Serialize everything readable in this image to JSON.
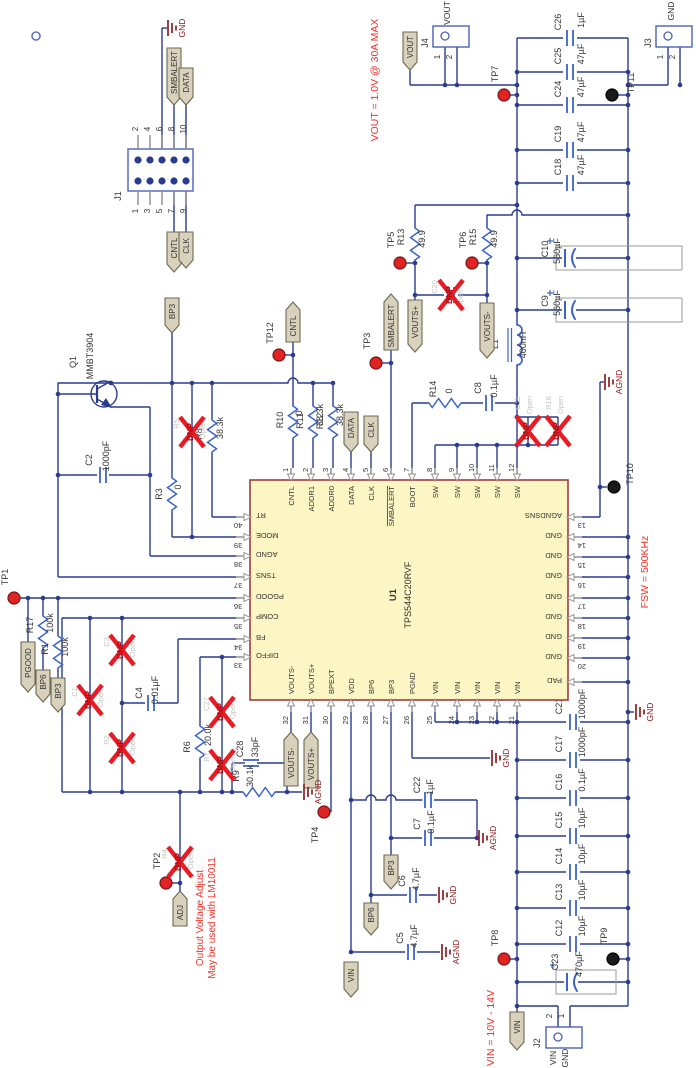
{
  "notes": {
    "vout": "VOUT = 1.0V @ 30A MAX",
    "fsw": "FSW = 500KHz",
    "vin": "VIN = 10V - 14V",
    "adj_line1": "Output Voltage Adjust",
    "adj_line2": "May be used with LM10011"
  },
  "nets": {
    "smbalert": "SMBALERT",
    "data": "DATA",
    "cntl": "CNTL",
    "clk": "CLK",
    "vout": "VOUT",
    "vin": "VIN",
    "gnd": "GND",
    "agnd": "AGND",
    "bp3": "BP3",
    "bp6": "BP6",
    "pgood": "PGOOD",
    "adj": "ADJ",
    "vouts_plus": "VOUTS+",
    "vouts_minus": "VOUTS-"
  },
  "ic": {
    "ref": "U1",
    "part": "TPS544C20RVF",
    "pad": "PAD",
    "top_pins": [
      {
        "num": "1",
        "name": "CNTL"
      },
      {
        "num": "2",
        "name": "ADDR1"
      },
      {
        "num": "3",
        "name": "ADDR0"
      },
      {
        "num": "4",
        "name": "DATA"
      },
      {
        "num": "5",
        "name": "CLK"
      },
      {
        "num": "6",
        "name": "SMBALERT",
        "bar": true
      },
      {
        "num": "7",
        "name": "BOOT"
      },
      {
        "num": "8",
        "name": "SW"
      },
      {
        "num": "9",
        "name": "SW"
      },
      {
        "num": "10",
        "name": "SW"
      },
      {
        "num": "11",
        "name": "SW"
      },
      {
        "num": "12",
        "name": "SW"
      }
    ],
    "bottom_pins": [
      {
        "num": "32",
        "name": "VOUTS-"
      },
      {
        "num": "31",
        "name": "VOUTS+"
      },
      {
        "num": "30",
        "name": "BPEXT"
      },
      {
        "num": "29",
        "name": "VDD"
      },
      {
        "num": "28",
        "name": "BP6"
      },
      {
        "num": "27",
        "name": "BP3"
      },
      {
        "num": "26",
        "name": "PGND"
      },
      {
        "num": "25",
        "name": "VIN"
      },
      {
        "num": "24",
        "name": "VIN"
      },
      {
        "num": "23",
        "name": "VIN"
      },
      {
        "num": "22",
        "name": "VIN"
      },
      {
        "num": "21",
        "name": "VIN"
      }
    ],
    "left_pins": [
      {
        "num": "40",
        "name": "RT"
      },
      {
        "num": "39",
        "name": "MODE"
      },
      {
        "num": "38",
        "name": "AGND"
      },
      {
        "num": "37",
        "name": "TSNS"
      },
      {
        "num": "36",
        "name": "PGOOD"
      },
      {
        "num": "35",
        "name": "COMP"
      },
      {
        "num": "34",
        "name": "FB"
      },
      {
        "num": "33",
        "name": "DIFFO"
      }
    ],
    "right_pins": [
      {
        "num": "13",
        "name": "AGNDSNS"
      },
      {
        "num": "14",
        "name": "GND"
      },
      {
        "num": "15",
        "name": "GND"
      },
      {
        "num": "16",
        "name": "GND"
      },
      {
        "num": "17",
        "name": "GND"
      },
      {
        "num": "18",
        "name": "GND"
      },
      {
        "num": "19",
        "name": "GND"
      },
      {
        "num": "20",
        "name": "GND"
      }
    ]
  },
  "components": {
    "Q1": {
      "ref": "Q1",
      "value": "MMBT3904"
    },
    "L1": {
      "ref": "L1",
      "value": "400nH"
    },
    "C2": {
      "ref": "C2",
      "value": "1000pF"
    },
    "C4": {
      "ref": "C4",
      "value": "0.01µF"
    },
    "C5": {
      "ref": "C5",
      "value": "4.7µF"
    },
    "C6": {
      "ref": "C6",
      "value": "4.7µF"
    },
    "C7": {
      "ref": "C7",
      "value": "0.1µF"
    },
    "C8": {
      "ref": "C8",
      "value": "0.1µF"
    },
    "C9": {
      "ref": "C9",
      "value": "560µF"
    },
    "C10": {
      "ref": "C10",
      "value": "560µF"
    },
    "C12": {
      "ref": "C12",
      "value": "10µF"
    },
    "C13": {
      "ref": "C13",
      "value": "10µF"
    },
    "C14": {
      "ref": "C14",
      "value": "10µF"
    },
    "C15": {
      "ref": "C15",
      "value": "10µF"
    },
    "C16": {
      "ref": "C16",
      "value": "0.1µF"
    },
    "C17": {
      "ref": "C17",
      "value": "1000pF"
    },
    "C18": {
      "ref": "C18",
      "value": "47µF"
    },
    "C19": {
      "ref": "C19",
      "value": "47µF"
    },
    "C21": {
      "ref": "C21",
      "value": "1000pF"
    },
    "C22": {
      "ref": "C22",
      "value": "1µF"
    },
    "C23": {
      "ref": "C23",
      "value": "470µF"
    },
    "C24": {
      "ref": "C24",
      "value": "47µF"
    },
    "C25": {
      "ref": "C25",
      "value": "47µF"
    },
    "C26": {
      "ref": "C26",
      "value": "1µF"
    },
    "C28": {
      "ref": "C28",
      "value": "33pF"
    },
    "R1": {
      "ref": "R1",
      "value": "100k"
    },
    "R3": {
      "ref": "R3",
      "value": "0"
    },
    "R6": {
      "ref": "R6",
      "value": "20.0k"
    },
    "R8": {
      "ref": "R8",
      "value": "38.3k"
    },
    "R9": {
      "ref": "R9",
      "value": "30.1k"
    },
    "R10": {
      "ref": "R10",
      "value": "0"
    },
    "R11": {
      "ref": "R11",
      "value": "38.3k"
    },
    "R12": {
      "ref": "R12",
      "value": "38.3k"
    },
    "R13": {
      "ref": "R13",
      "value": "49.9"
    },
    "R14": {
      "ref": "R14",
      "value": "0"
    },
    "R15": {
      "ref": "R15",
      "value": "49.9"
    },
    "R17": {
      "ref": "R17",
      "value": "100k"
    }
  },
  "dnp_mark": "DNP",
  "dnp_parts": {
    "C1": {
      "ref": "C1",
      "note": "Open"
    },
    "C3": {
      "ref": "C3",
      "note": "Open"
    },
    "R2": {
      "ref": "R2",
      "note": "Open"
    },
    "R4": {
      "ref": "R4",
      "note": "Open"
    },
    "R5": {
      "ref": "R5",
      "note": "Open"
    },
    "R7": {
      "ref": "R7",
      "note": "Open"
    },
    "C27": {
      "ref": "C27",
      "note": "Open"
    },
    "C20": {
      "ref": "C20",
      "note": "Open"
    },
    "C11": {
      "ref": "C11",
      "note": "Open"
    },
    "R16": {
      "ref": "R16",
      "note": "Open"
    }
  },
  "testpoints": {
    "TP1": {
      "label": "TP1",
      "style": "red"
    },
    "TP2": {
      "label": "TP2",
      "style": "red"
    },
    "TP3": {
      "label": "TP3",
      "style": "red"
    },
    "TP4": {
      "label": "TP4",
      "style": "red"
    },
    "TP5": {
      "label": "TP5",
      "style": "red"
    },
    "TP6": {
      "label": "TP6",
      "style": "red"
    },
    "TP7": {
      "label": "TP7",
      "style": "red"
    },
    "TP8": {
      "label": "TP8",
      "style": "red"
    },
    "TP9": {
      "label": "TP9",
      "style": "black"
    },
    "TP10": {
      "label": "TP10",
      "style": "black"
    },
    "TP11": {
      "label": "TP11",
      "style": "black"
    },
    "TP12": {
      "label": "TP12",
      "style": "red"
    }
  },
  "connectors": {
    "J1": {
      "ref": "J1",
      "pins_top": [
        "2",
        "4",
        "6",
        "8",
        "10"
      ],
      "pins_bottom": [
        "1",
        "3",
        "5",
        "7",
        "9"
      ]
    },
    "J2": {
      "ref": "J2",
      "pin_numbers": [
        "2",
        "1"
      ],
      "pin_labels": [
        "VIN",
        "GND"
      ]
    },
    "J3": {
      "ref": "J3",
      "net": "GND",
      "pin_numbers": [
        "1",
        "2"
      ]
    },
    "J4": {
      "ref": "J4",
      "net": "VOUT",
      "pin_numbers": [
        "1",
        "2"
      ]
    }
  },
  "colors": {
    "wire": "#2a3c8f",
    "component": "#3c64c8",
    "grey": "#8c8c8c",
    "ic_fill": "#fbf6c3",
    "ic_border": "#a03c3c",
    "dnp": "#e81c24",
    "dnp_text": "#a50f16",
    "dnp_grey": "#c4c4c4",
    "note": "#f2332a",
    "ground": "#8b1f22",
    "tp_red": "#e02424",
    "tp_black": "#1a1a1a",
    "pennant_fill": "#d8d2bc",
    "pennant_stroke": "#6e6852",
    "text": "#333333",
    "case": "#9a9a9a"
  }
}
